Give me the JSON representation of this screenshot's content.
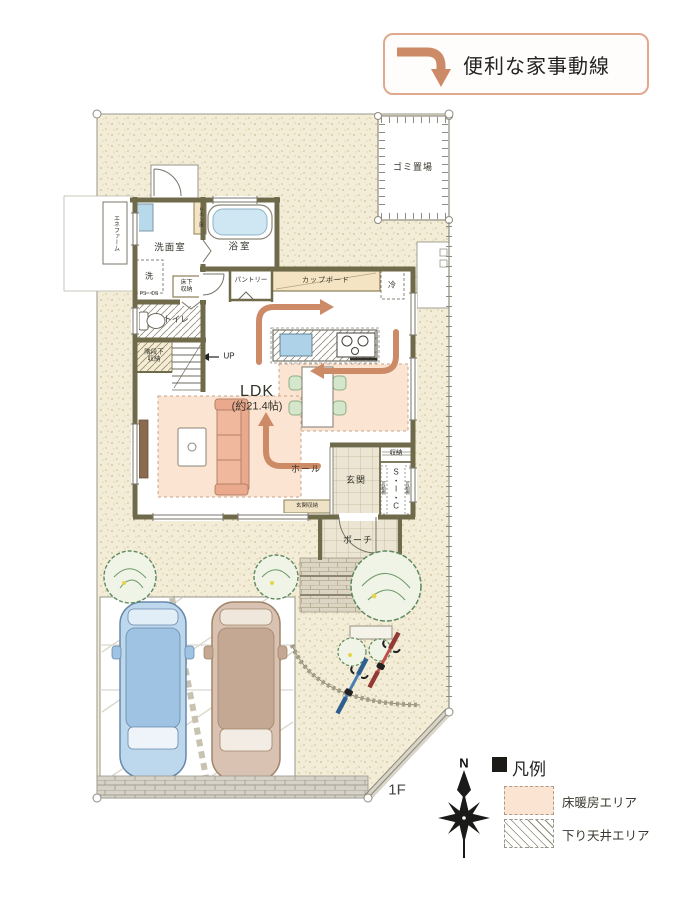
{
  "header": {
    "flow_note": "便利な家事動線"
  },
  "plan": {
    "floor_label": "1F",
    "rooms": {
      "washroom": "洗面室",
      "bath": "浴室",
      "toilet": "トイレ",
      "pantry": "パントリー",
      "ldk_name": "LDK",
      "ldk_size": "(約21.4帖)",
      "hall": "ホール",
      "entrance": "玄関",
      "porch": "ポーチ"
    },
    "fixtures": {
      "garbage": "ゴミ置場",
      "enefarm": "エネファーム",
      "linen": "リネン庫",
      "washer": "洗",
      "ps_ds": "PS・DS",
      "underfloor_storage": "床下収納",
      "stair_storage": "階段下収納",
      "up": "UP",
      "cupboard": "カップボード",
      "fridge": "冷",
      "storage": "収納",
      "sic": "S・I・C",
      "movable_shelf_left": "可動棚",
      "movable_shelf_right": "可動棚",
      "entrance_storage": "玄関収納"
    }
  },
  "legend": {
    "title": "凡例",
    "compass_north": "N",
    "items": [
      {
        "label": "床暖房エリア",
        "swatch": "floor-heating"
      },
      {
        "label": "下り天井エリア",
        "swatch": "lowered-ceiling"
      }
    ]
  },
  "colors": {
    "flow_arrow": "#cd8a66",
    "wall": "#6f6a4a",
    "floor_heating": "#fbe4d1",
    "site_ground": "#f3edd8",
    "accent_border": "#e0a98f",
    "car_blue": "#bdd7ec",
    "car_tan": "#d9c2b2",
    "tub_water": "#cfe7f2",
    "chair_green": "#d4e6cc",
    "sofa": "#eaa98c"
  }
}
